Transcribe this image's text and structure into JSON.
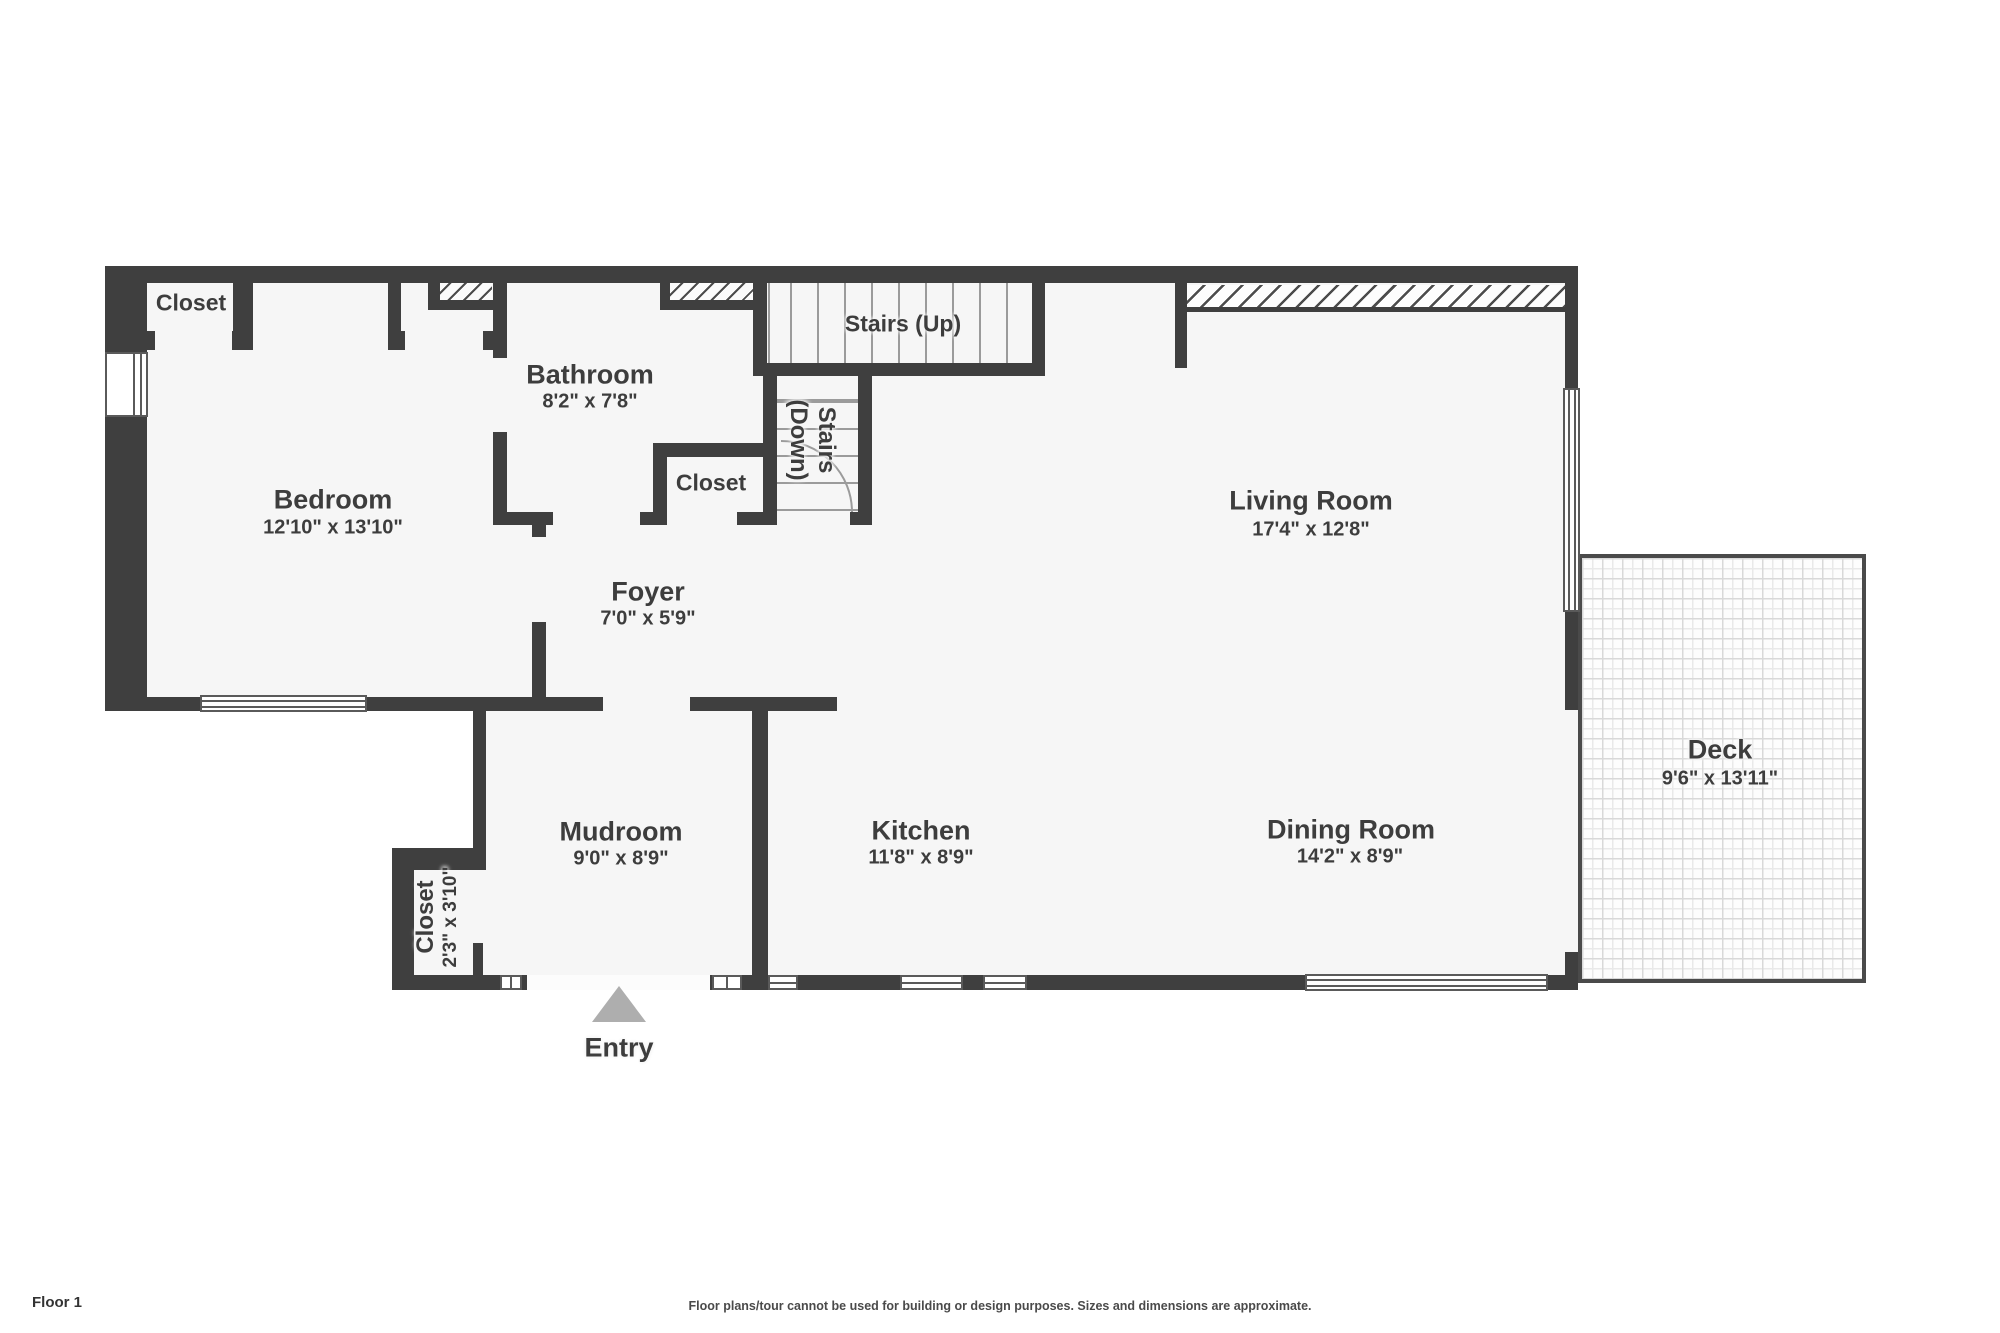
{
  "rooms": {
    "bedroom": {
      "name": "Bedroom",
      "dims": "12'10\" x 13'10\""
    },
    "bedroom_closet": {
      "name": "Closet"
    },
    "bathroom": {
      "name": "Bathroom",
      "dims": "8'2\" x 7'8\""
    },
    "hall_closet": {
      "name": "Closet"
    },
    "stairs_up": {
      "name": "Stairs (Up)"
    },
    "stairs_down": {
      "line1": "Stairs",
      "line2": "(Down)"
    },
    "foyer": {
      "name": "Foyer",
      "dims": "7'0\" x 5'9\""
    },
    "living_room": {
      "name": "Living Room",
      "dims": "17'4\" x 12'8\""
    },
    "mudroom": {
      "name": "Mudroom",
      "dims": "9'0\" x 8'9\""
    },
    "mudroom_closet": {
      "name": "Closet",
      "dims": "2'3\" x 3'10\""
    },
    "kitchen": {
      "name": "Kitchen",
      "dims": "11'8\" x 8'9\""
    },
    "dining_room": {
      "name": "Dining Room",
      "dims": "14'2\" x 8'9\""
    },
    "deck": {
      "name": "Deck",
      "dims": "9'6\" x 13'11\""
    },
    "entry": {
      "label": "Entry"
    }
  },
  "footer": {
    "floor_label": "Floor 1",
    "disclaimer": "Floor plans/tour cannot be used for building or design purposes. Sizes and dimensions are approximate."
  },
  "colors": {
    "wall": "#3f3f3f",
    "floor": "#f6f6f6",
    "label_text": "#3d3d3d",
    "entry_arrow": "#aeaeae",
    "deck_tile": "#d9d9d9"
  }
}
